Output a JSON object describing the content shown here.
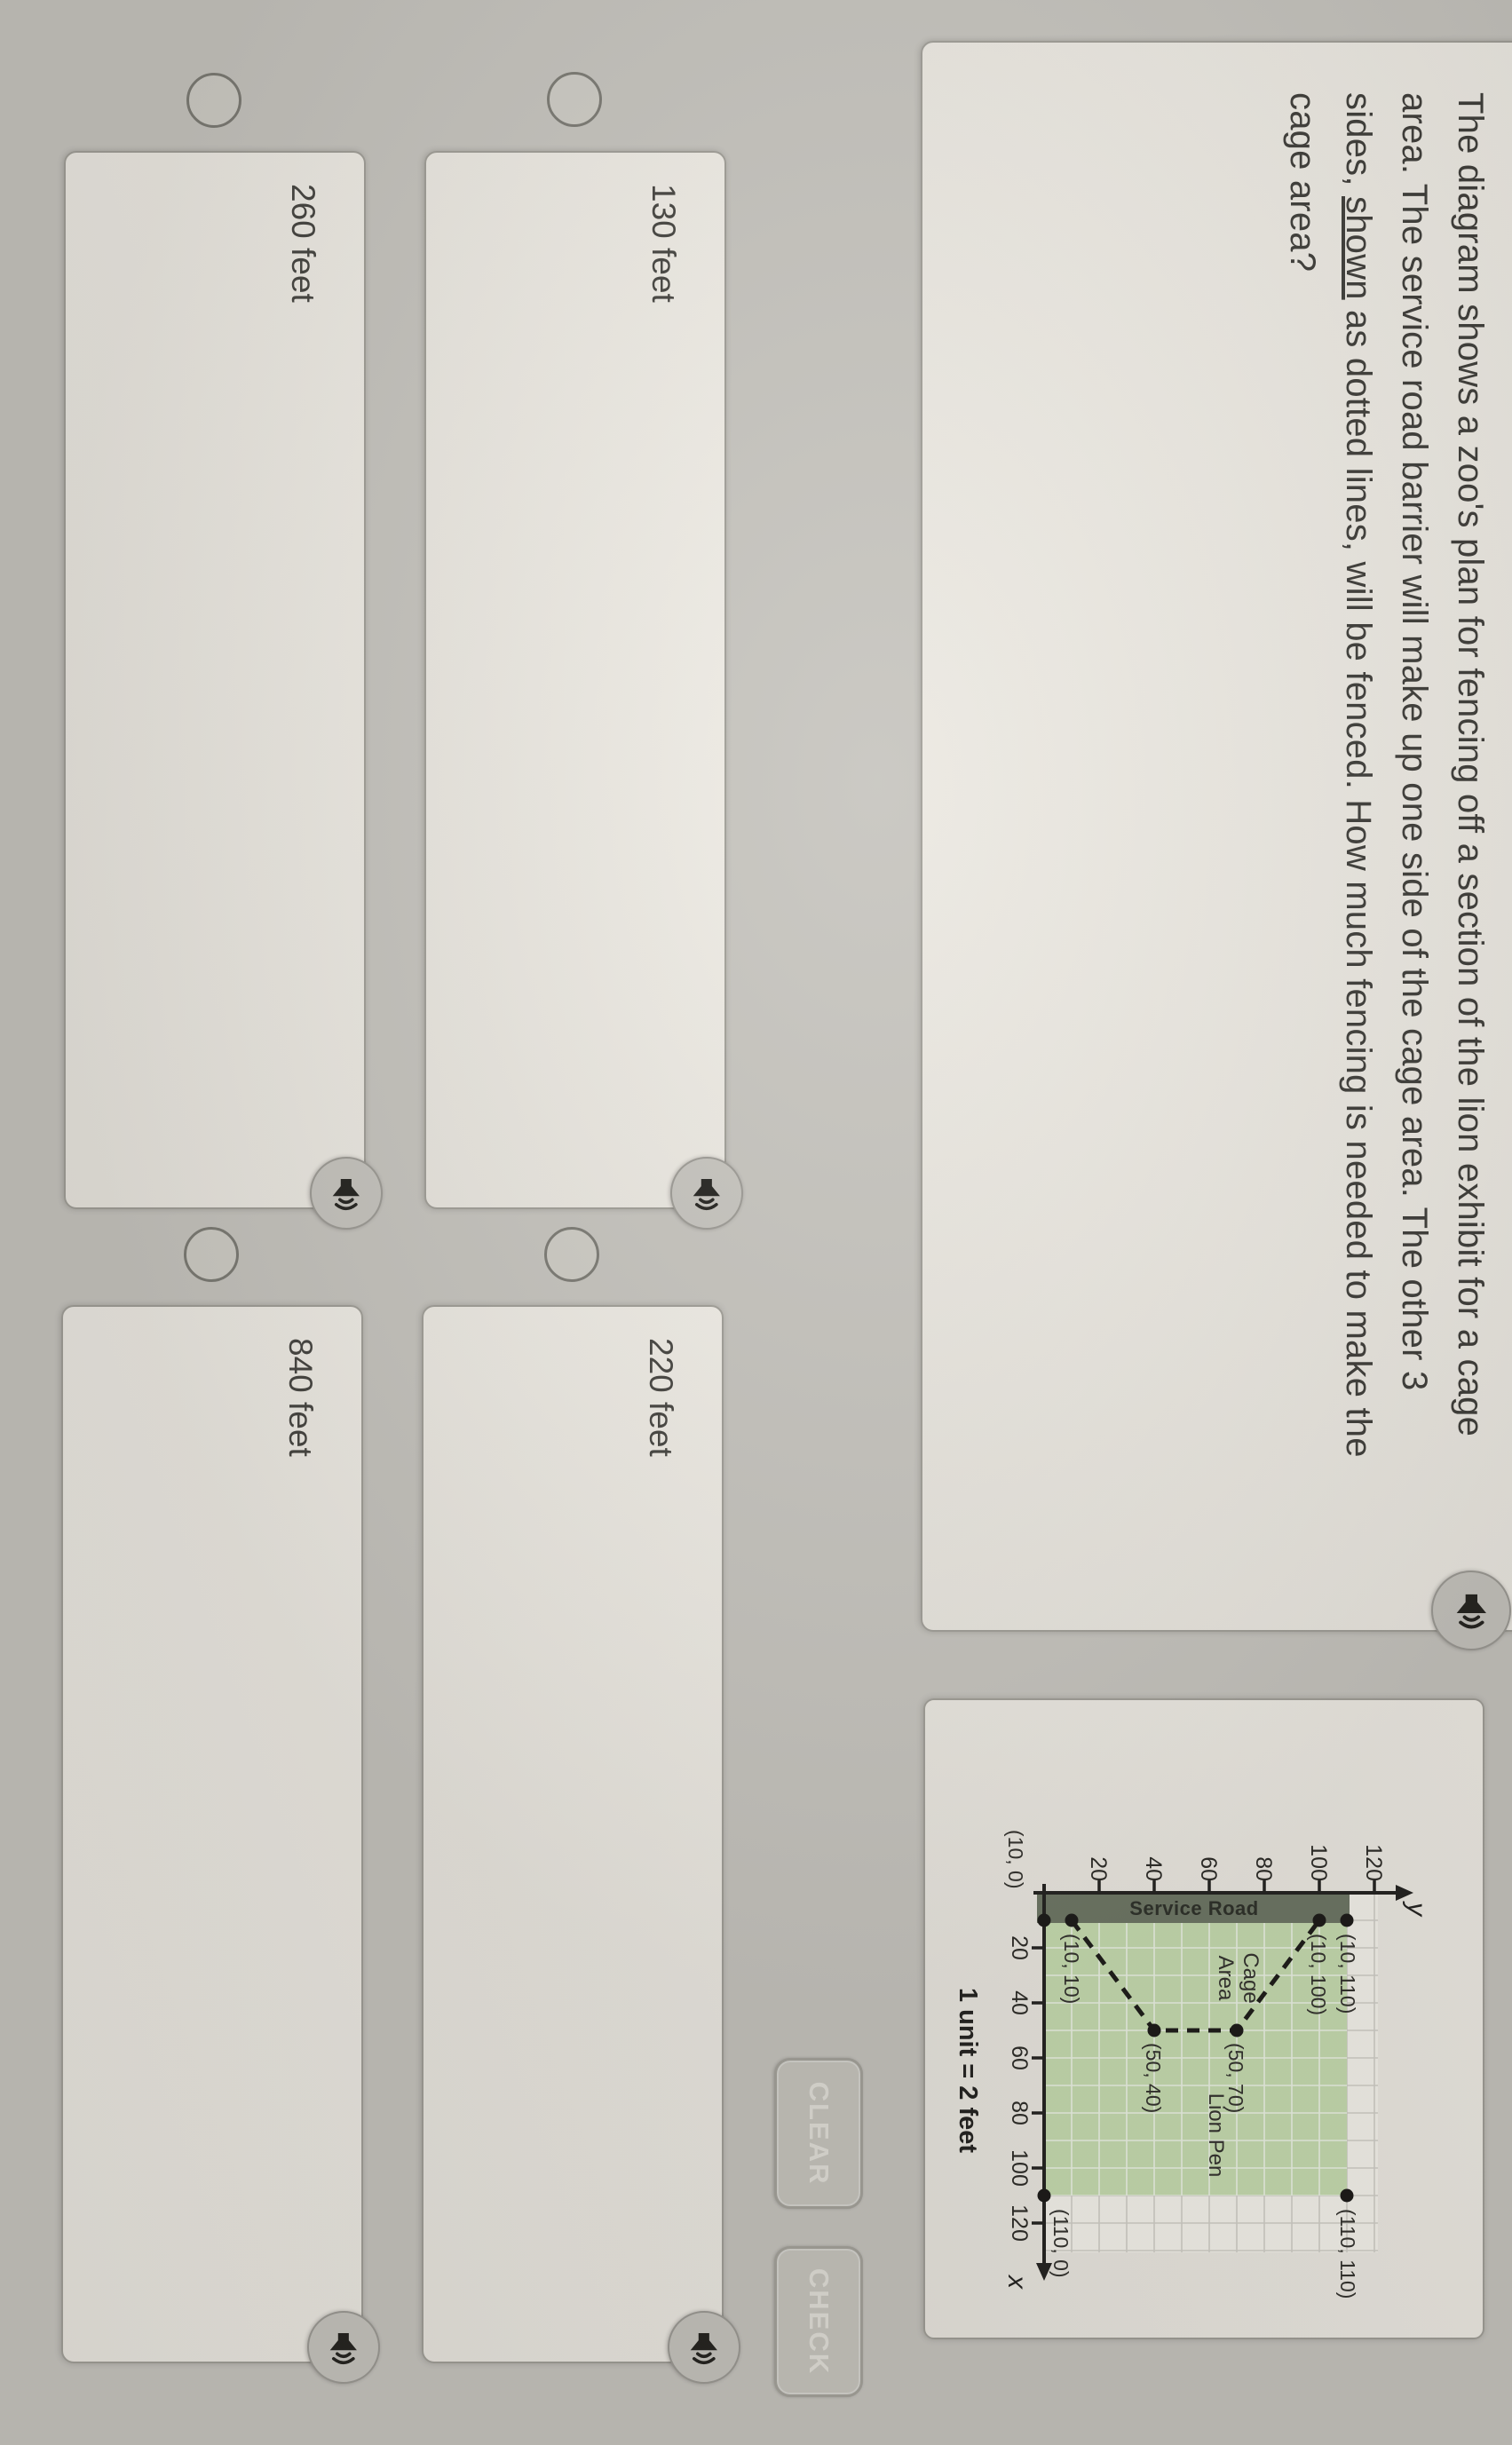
{
  "question": {
    "line1": "The diagram shows a zoo's plan for fencing off a section of the lion exhibit for a cage",
    "line2": "area. The service road barrier will make up one side of the cage area. The other 3",
    "line3_pre": "sides, ",
    "line3_underlined": "shown",
    "line3_post": " as dotted lines, will be fenced. How much fencing is needed to make the",
    "line4": "cage area?"
  },
  "answers": [
    {
      "label": "130 feet"
    },
    {
      "label": "220 feet"
    },
    {
      "label": "260 feet"
    },
    {
      "label": "840 feet"
    }
  ],
  "buttons": {
    "clear": "CLEAR",
    "check": "CHECK"
  },
  "plot": {
    "x_axis_label": "x",
    "y_axis_label": "y",
    "x_ticks": [
      "20",
      "40",
      "60",
      "80",
      "100",
      "120"
    ],
    "y_ticks": [
      "20",
      "40",
      "60",
      "80",
      "100",
      "120"
    ],
    "service_road": "Service Road",
    "cage_area_line1": "Cage",
    "cage_area_line2": "Area",
    "lion_pen": "Lion Pen",
    "unit_note": "1 unit = 2 feet",
    "point_labels": {
      "p10_0": "(10, 0)",
      "p10_10": "(10, 10)",
      "p50_40": "(50, 40)",
      "p50_70": "(50, 70)",
      "p10_100": "(10, 100)",
      "p10_110": "(10, 110)",
      "p110_110": "(110, 110)",
      "p110_0": "(110, 0)"
    }
  },
  "colors": {
    "background": "#c7c5bf",
    "card": "#efece5",
    "green_fill": "#c8deb1",
    "road_fill": "#6e7765",
    "ink": "#232220"
  },
  "chart_data": {
    "type": "scatter",
    "xlabel": "x",
    "ylabel": "y",
    "x_ticks": [
      20,
      40,
      60,
      80,
      100,
      120
    ],
    "y_ticks": [
      20,
      40,
      60,
      80,
      100,
      120
    ],
    "xlim": [
      0,
      130
    ],
    "ylim": [
      0,
      130
    ],
    "grid": true,
    "unit_note": "1 unit = 2 feet",
    "points": [
      {
        "x": 10,
        "y": 0,
        "label": "(10, 0)"
      },
      {
        "x": 10,
        "y": 10,
        "label": "(10, 10)"
      },
      {
        "x": 50,
        "y": 40,
        "label": "(50, 40)"
      },
      {
        "x": 50,
        "y": 70,
        "label": "(50, 70)"
      },
      {
        "x": 10,
        "y": 100,
        "label": "(10, 100)"
      },
      {
        "x": 10,
        "y": 110,
        "label": "(10, 110)"
      },
      {
        "x": 110,
        "y": 110,
        "label": "(110, 110)"
      },
      {
        "x": 110,
        "y": 0,
        "label": "(110, 0)"
      }
    ],
    "dashed_segments": [
      [
        [
          10,
          10
        ],
        [
          50,
          40
        ]
      ],
      [
        [
          50,
          40
        ],
        [
          50,
          70
        ]
      ],
      [
        [
          50,
          70
        ],
        [
          10,
          100
        ]
      ]
    ],
    "shaded_region": {
      "rect": [
        [
          0,
          0
        ],
        [
          110,
          110
        ]
      ],
      "fill": "#c8deb1",
      "label": "Lion Pen"
    },
    "service_road_band": {
      "label": "Service Road",
      "x_range": [
        0,
        10
      ],
      "fill": "#6e7765"
    },
    "area_labels": [
      {
        "text": "Cage Area",
        "x": 30,
        "y": 57
      },
      {
        "text": "Lion Pen",
        "x": 85,
        "y": 55
      }
    ]
  }
}
